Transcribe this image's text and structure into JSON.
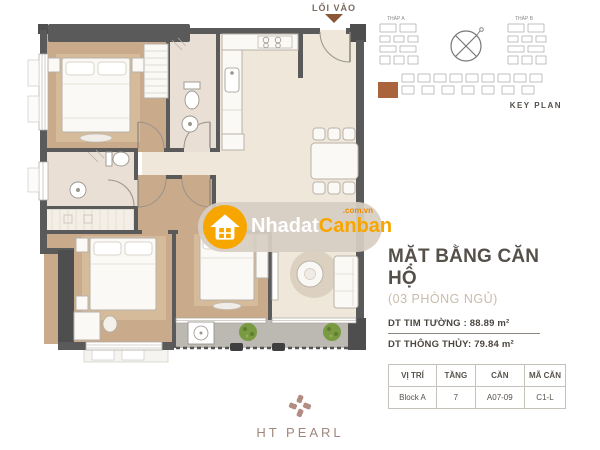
{
  "entrance": {
    "label": "LỐI VÀO"
  },
  "key_plan": {
    "label": "KEY PLAN",
    "tower_a": "THÁP A",
    "tower_b": "THÁP B",
    "highlight_color": "#a9643c"
  },
  "info": {
    "title": "MẶT BẰNG CĂN HỘ",
    "subtitle": "(03 PHÒNG NGỦ)",
    "area_line1": "DT TIM TƯỜNG : 88.89 m²",
    "area_line2": "DT THÔNG THỦY: 79.84 m²",
    "table": {
      "headers": [
        "VỊ TRÍ",
        "TẦNG",
        "CĂN",
        "MÃ CĂN"
      ],
      "row": [
        "Block A",
        "7",
        "A07-09",
        "C1-L"
      ]
    }
  },
  "watermark": {
    "text_primary": "Nhadat",
    "text_secondary": "Canban",
    "text_domain": ".com.vn",
    "orange": "#f7a600"
  },
  "brand": {
    "name": "HT PEARL",
    "color": "#a1867b"
  },
  "plan_colors": {
    "wall": "#5a5a5a",
    "wood_floor": "#c9aa8b",
    "tile_floor": "#efe7da",
    "bath_floor": "#e9dfd5",
    "balcony_floor": "#bcb8b2",
    "plant_green": "#7a9a42"
  }
}
